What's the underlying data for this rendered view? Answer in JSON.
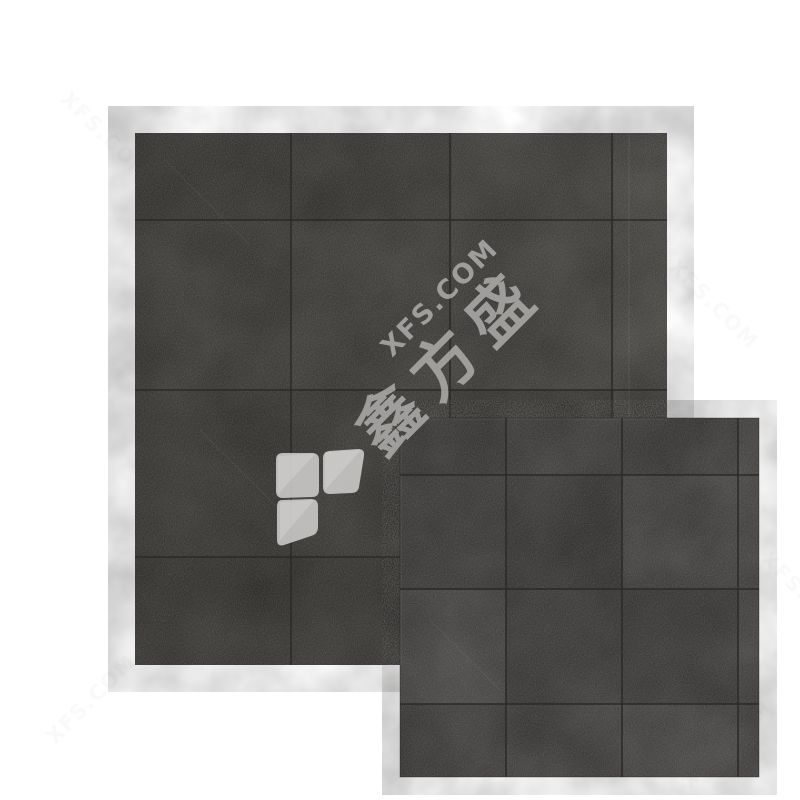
{
  "meta": {
    "description": "Product photo of dark charcoal concrete-look floor tiles shown as two overlapping square tile swatches on a white background with brand watermark"
  },
  "colors": {
    "background": "#ffffff",
    "tile_base_large": "#413f3c",
    "tile_base_small": "#444241",
    "grout": "#2b2927",
    "faint_mark": "#8f8f8d"
  },
  "watermark": {
    "latin": "XFS.COM",
    "chinese": "鑫方盛",
    "text_color": "#b5b4b2",
    "logo_color": "#cac9c7"
  }
}
